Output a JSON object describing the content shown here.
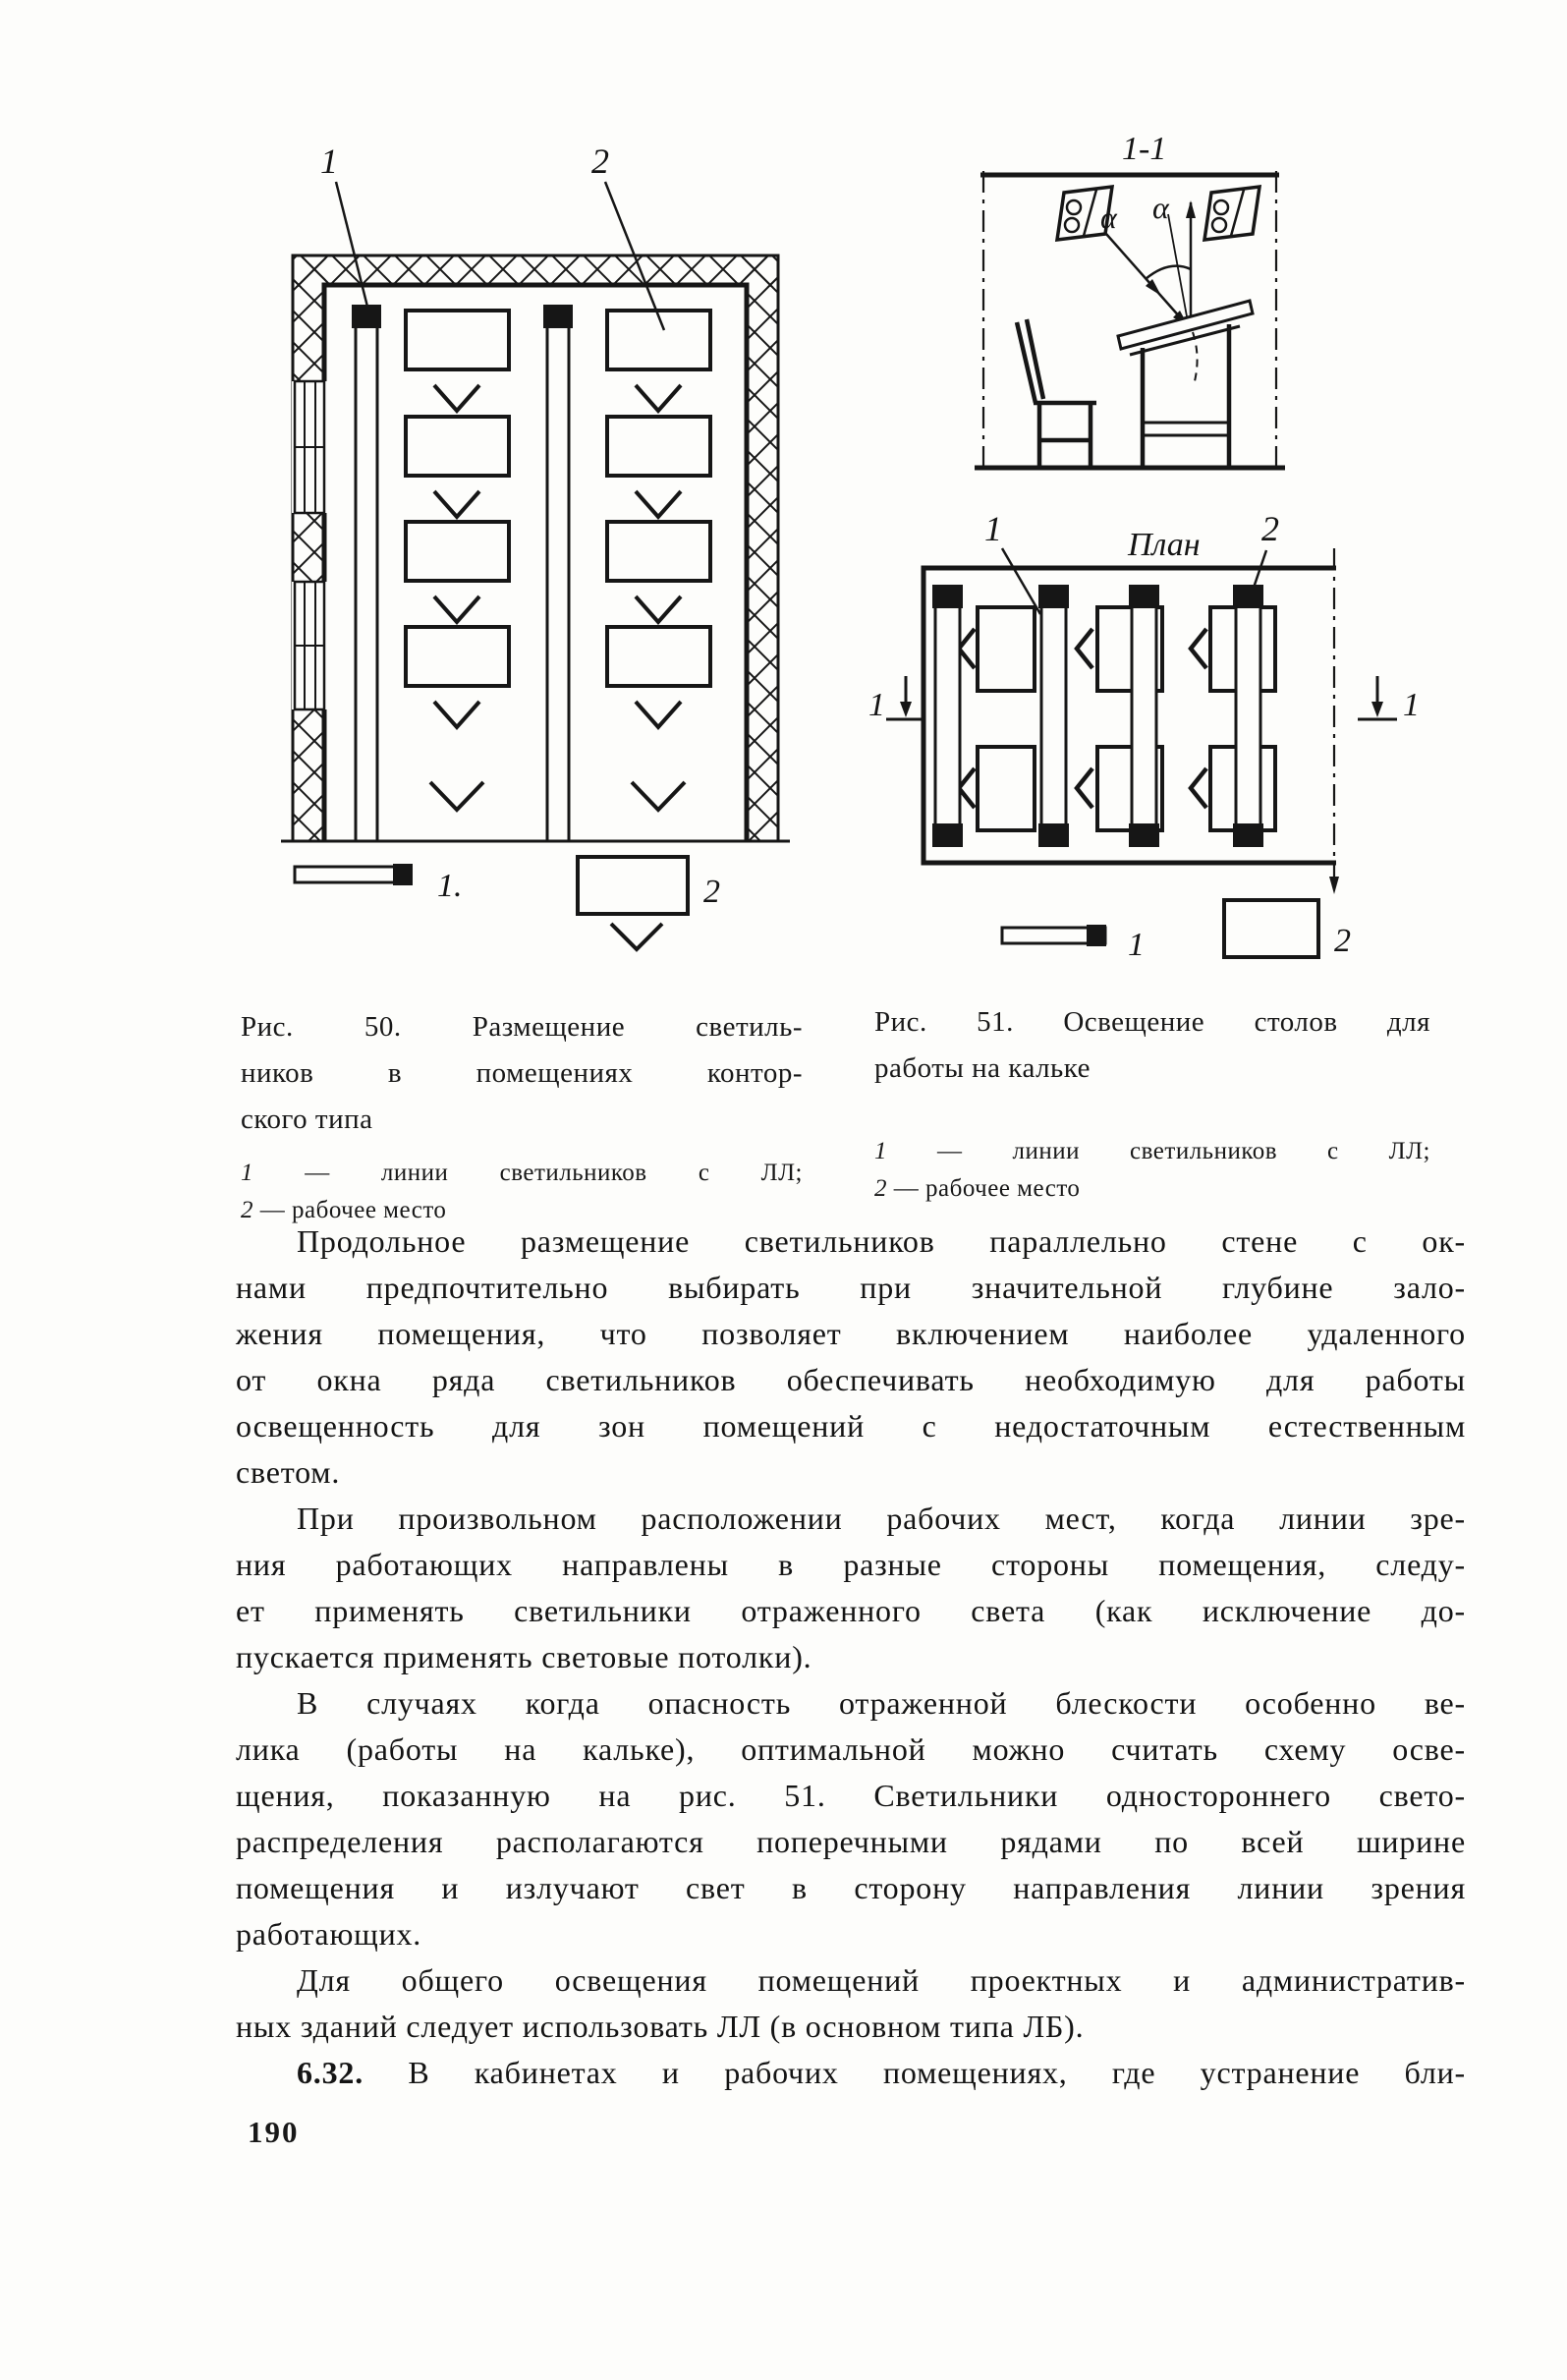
{
  "page": {
    "number": "190"
  },
  "fig50": {
    "callout1": "1",
    "callout2": "2",
    "legend_marker1": "1.",
    "legend_marker2": "2",
    "caption": {
      "line1": "Рис. 50. Размещение светиль-",
      "line2": "ников в помещениях контор-",
      "line3": "ского типа"
    },
    "legend": {
      "item1_num": "1",
      "item1_text": "— линии светильников с ЛЛ;",
      "item2_num": "2",
      "item2_text": "— рабочее место"
    }
  },
  "fig51": {
    "section_title": "1-1",
    "alpha_left": "α",
    "alpha_right": "α",
    "plan_title": "План",
    "callout1": "1",
    "callout2": "2",
    "section_mark_left": "1",
    "section_mark_right": "1",
    "legend_marker1": "1",
    "legend_marker2": "2",
    "caption": {
      "line1": "Рис. 51. Освещение столов для",
      "line2": "работы на кальке"
    },
    "legend": {
      "item1_num": "1",
      "item1_text": "— линии светильников с ЛЛ;",
      "item2_num": "2",
      "item2_text": "— рабочее место"
    }
  },
  "body": {
    "p1": [
      "Продольное размещение светильников параллельно стене с ок-",
      "нами предпочтительно выбирать при значительной глубине зало-",
      "жения помещения, что позволяет включением наиболее удаленного",
      "от окна ряда светильников обеспечивать необходимую для работы",
      "освещенность для зон помещений с недостаточным естественным",
      "светом."
    ],
    "p2": [
      "При произвольном расположении рабочих мест, когда линии зре-",
      "ния работающих направлены в разные стороны помещения, следу-",
      "ет применять светильники отраженного света (как исключение до-",
      "пускается применять световые потолки)."
    ],
    "p3": [
      "В случаях когда опасность отраженной блескости особенно ве-",
      "лика (работы на кальке), оптимальной можно считать схему осве-",
      "щения, показанную на рис. 51. Светильники одностороннего свето-",
      "распределения располагаются поперечными рядами по всей ширине",
      "помещения и излучают свет в сторону направления линии зрения",
      "работающих."
    ],
    "p4": [
      "Для общего освещения помещений проектных и административ-",
      "ных зданий следует использовать ЛЛ (в основном типа ЛБ)."
    ],
    "p5_num": "6.32.",
    "p5_text": "В кабинетах и рабочих помещениях, где устранение бли-"
  }
}
